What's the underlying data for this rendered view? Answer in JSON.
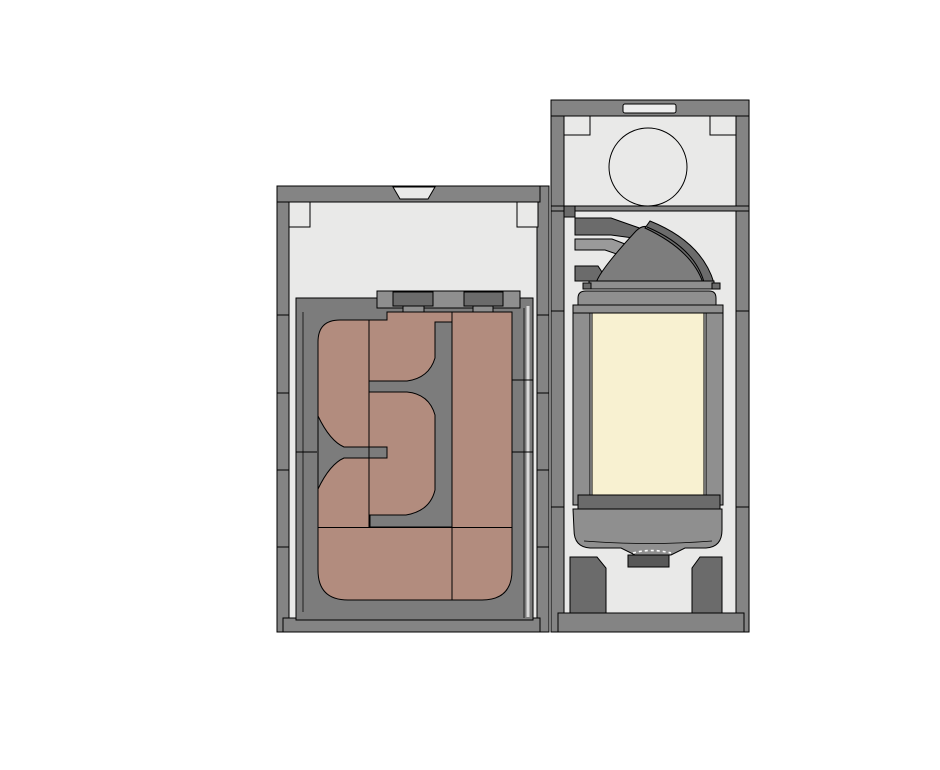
{
  "drawing": {
    "kind": "cad-plan-view",
    "description_visible_text": "",
    "modules": {
      "left_module": {
        "label": "left-cabinet",
        "parts": [
          "outer-walls",
          "top-vent-notch",
          "corner-brackets",
          "inner-frame",
          "raised-port-plate",
          "port-left",
          "port-right",
          "serpentine-channel",
          "channel-baffle-tee",
          "channel-baffle-j",
          "channel-stub",
          "panel-seams"
        ]
      },
      "right_module": {
        "label": "right-cabinet",
        "parts": [
          "outer-walls",
          "top-slot",
          "corner-brackets",
          "fan-circle",
          "duct-bands",
          "duct-cone",
          "duct-crest",
          "neck-ledge",
          "neck-bell",
          "window-frame",
          "window-pane",
          "drip-pan",
          "drain-stub",
          "foot-left",
          "foot-right",
          "base-bar"
        ]
      }
    }
  },
  "colors": {
    "bg": "#ffffff",
    "interior": "#e9e9e8",
    "wall": "#848484",
    "frame": "#7c7c7c",
    "panel": "#8f8f8f",
    "dark": "#6b6b6b",
    "darker": "#585858",
    "mid": "#9a9a9a",
    "channel": "#b28c7e",
    "window": "#f8f1d1",
    "gapline": "#d9d9d9"
  }
}
